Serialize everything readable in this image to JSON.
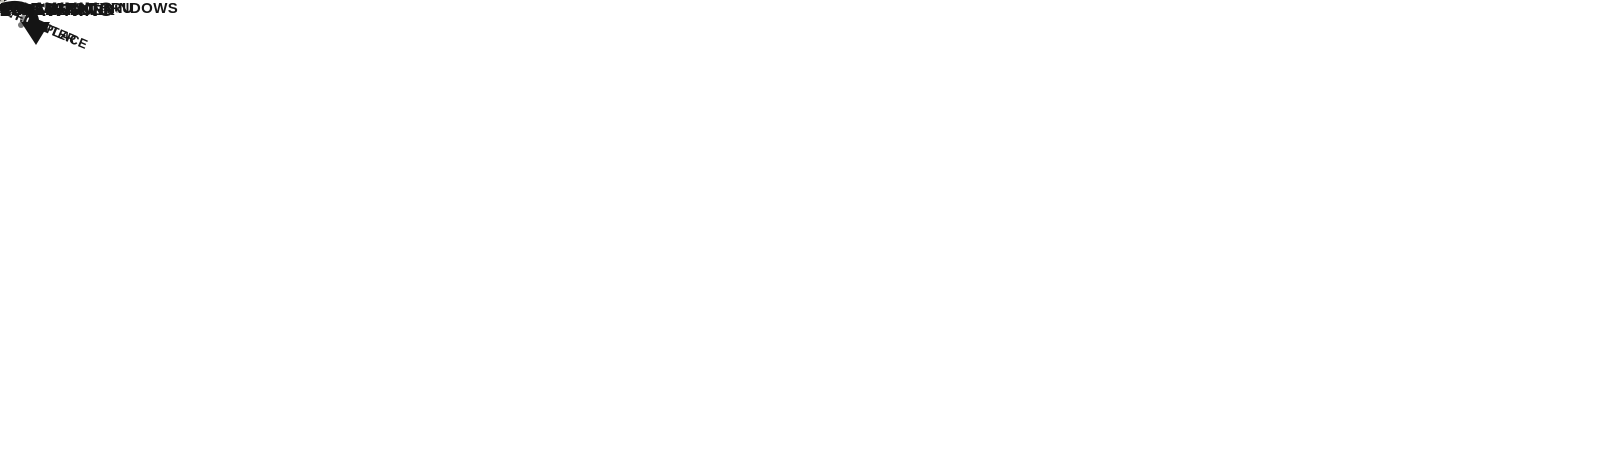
{
  "colors": {
    "wall": "#1f1f1f",
    "floor": "#cfccbf",
    "floor_bedroom": "#d6d3c5",
    "cabinet_dark_wood": "#4c392b",
    "sofa_brown": "#5d4836",
    "counter_white": "#f3f2ed",
    "appliance_black": "#131313",
    "mattress_cream": "#e9e6d6",
    "shower_glass_teal": "#8fa7a3",
    "cap_accent_gold": "#c08a28"
  },
  "labels": {
    "panoramic_windows": "PANORAMIC WINDOWS",
    "dinette": "DINETTE",
    "versa_lounge": "VERSA-LOUNGE",
    "full_pass_thru": {
      "l1": "FULL PASS THRU",
      "l2": "STORAGE"
    },
    "shelves": "SHELVES",
    "desk_ohc": "OHC",
    "desk": "DESK",
    "bunk": {
      "l1": "46 x 74",
      "l2": "DOUBLE OVER",
      "l3": "DOUBLE BUNK"
    },
    "ent_center": {
      "l1": "ENT.CENTER",
      "l2": "W/ FIREPLACE"
    },
    "hidden_pantry": {
      "l1": "HIDDEN",
      "l2": "PANTRY"
    },
    "fridge": "FRIDGE",
    "micro": "MICRO",
    "kitchen_ohc": "OHC",
    "walk_in_shower": {
      "l1": "WALK-IN",
      "l2": "SHOWER"
    },
    "ward": {
      "l1": "WARD",
      "l2": "W/D PREP",
      "l3": "OPTION"
    },
    "closet": "CLOSET",
    "bedroom_ohc": "OHC",
    "king_bed": {
      "l1": "VERSA-TILT",
      "l2": "CUSTOM",
      "l3": "KING BED"
    },
    "awning": "20’ AWNING"
  }
}
